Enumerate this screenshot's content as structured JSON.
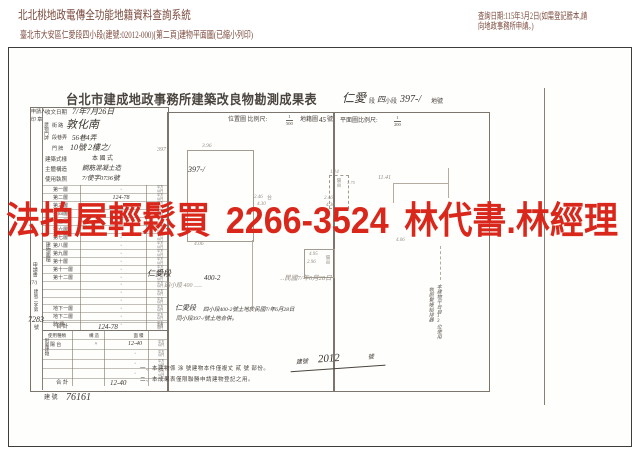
{
  "page": {
    "system_title": "北北桃地政電傳全功能地籍資料查詢系統",
    "query_date": "查詢日期:115年3月2日(如需登記謄本,請向地政事務所申請。)",
    "doc_line": "臺北市大安區仁愛段四小段(建號:02012-000)[第二頁]建物平面圖(已縮小列印)"
  },
  "watermark": {
    "left": "法拍屋輕鬆買",
    "phone": "2266-3524",
    "right": "林代書.林經理",
    "color": "#d9281b"
  },
  "survey_form": {
    "title": "台北市建成地政事務所建築改良物勘測成果表",
    "lot_header": {
      "section": "仁愛",
      "section_label": "段",
      "subsection": "四",
      "subsection_label": "小段",
      "number": "397-/",
      "number_label": "地號"
    },
    "applicant_label": "申請人",
    "seal_label": "印 章",
    "info_rows": [
      {
        "label": "收文日期",
        "value": "7/年7月26日"
      },
      {
        "label": "街 路",
        "value": "敦化南"
      },
      {
        "label": "段巷弄",
        "value": "56巷4弄"
      },
      {
        "label": "門 牌",
        "value": "10號 2樓之/"
      },
      {
        "label": "建築式樣",
        "value": "本 國 式"
      },
      {
        "label": "主體構造",
        "value": "鋼筋混凝土造"
      },
      {
        "label": "使用執照",
        "value": "7/使字0736號"
      }
    ],
    "address_group_label": "建物門牌",
    "floor_group_label": "建物面積",
    "unit_label": "平方公尺",
    "floor_rows": [
      {
        "label": "第一層",
        "value": "·"
      },
      {
        "label": "第二層",
        "value": "124-78"
      },
      {
        "label": "第三層",
        "value": "·"
      },
      {
        "label": "第四層",
        "value": "·"
      },
      {
        "label": "第五層",
        "value": "·"
      },
      {
        "label": "第六層",
        "value": "·"
      },
      {
        "label": "第七層",
        "value": "·"
      },
      {
        "label": "第八層",
        "value": "·"
      },
      {
        "label": "第九層",
        "value": "·"
      },
      {
        "label": "第十層",
        "value": "·"
      },
      {
        "label": "第十一層",
        "value": "·"
      },
      {
        "label": "第十二層",
        "value": "·"
      },
      {
        "label": "",
        "value": "·"
      },
      {
        "label": "",
        "value": "·"
      },
      {
        "label": "",
        "value": "·"
      },
      {
        "label": "地下一層",
        "value": "·"
      },
      {
        "label": "地下二層",
        "value": "·"
      },
      {
        "label": "騎 樓",
        "value": "·"
      }
    ],
    "floor_total": {
      "label": "合 計",
      "value": "124-78"
    },
    "annex_group_label": "附屬建物",
    "annex_headers": [
      "使用種類",
      "構 造",
      "面 積"
    ],
    "annex_rows": [
      {
        "type": "陽 台",
        "struct": "〃",
        "area": "12-40"
      },
      {
        "type": "",
        "struct": "",
        "area": "·"
      },
      {
        "type": "",
        "struct": "",
        "area": "·"
      },
      {
        "type": "",
        "struct": "",
        "area": "·"
      }
    ],
    "annex_total": {
      "label": "合 計",
      "value": "12-40"
    },
    "application": {
      "label": "申請書",
      "pre": "(7/)",
      "mid": "建地二字第",
      "num": "7283",
      "suf": "號"
    },
    "site_lines": {
      "line1_a": "仁愛段",
      "line1_b": "400-2",
      "line1_c": "‥民國7/年6月28日",
      "line1_faint": "四小段 400 ‥‥",
      "line2_a": "仁愛段",
      "line2_b": "四小段400-2號土地於民國7/年6月28日",
      "line3": "同小段397-/號土地合併。"
    },
    "stamp": {
      "prefix": "建號",
      "number": "2012",
      "suffix": "號"
    },
    "notes": [
      "一、本建物係 涂 號建物本件僅複丈 貳 號 部份。",
      "二、本成果表僅限聯勝申請建物登記之用。"
    ],
    "bottom_ref": {
      "label": "建 號",
      "value": "76161"
    },
    "vertical_note_left": "執照繫帳給排器",
    "vertical_note_right": "本建物平台自13位使用",
    "location_map": {
      "header": "位置圖 比例尺:",
      "scale_num": "1",
      "scale_den": "500",
      "sheet_label": "地籍圖",
      "sheet_no": "45",
      "sheet_suffix": "號",
      "lot_no": "397-/",
      "dim_top": "3.96",
      "dim_bottom": "4.06",
      "dim_side": "397",
      "cluster": {
        "d1": "2.46",
        "balcony": "台",
        "d2": "4.30"
      },
      "lower": {
        "d1": "4.95",
        "d2": "2.96",
        "balcony": "陽台"
      }
    },
    "floor_plan": {
      "header": "平面圖比例尺:",
      "scale_num": "1",
      "scale_den": "200",
      "dim_top": "11.41",
      "dim_mid": "4.06",
      "cluster": {
        "d1": "1.14",
        "balcony": "陽台",
        "d2": "2.46",
        "d3": "4.30",
        "d4": "3.75"
      }
    }
  }
}
